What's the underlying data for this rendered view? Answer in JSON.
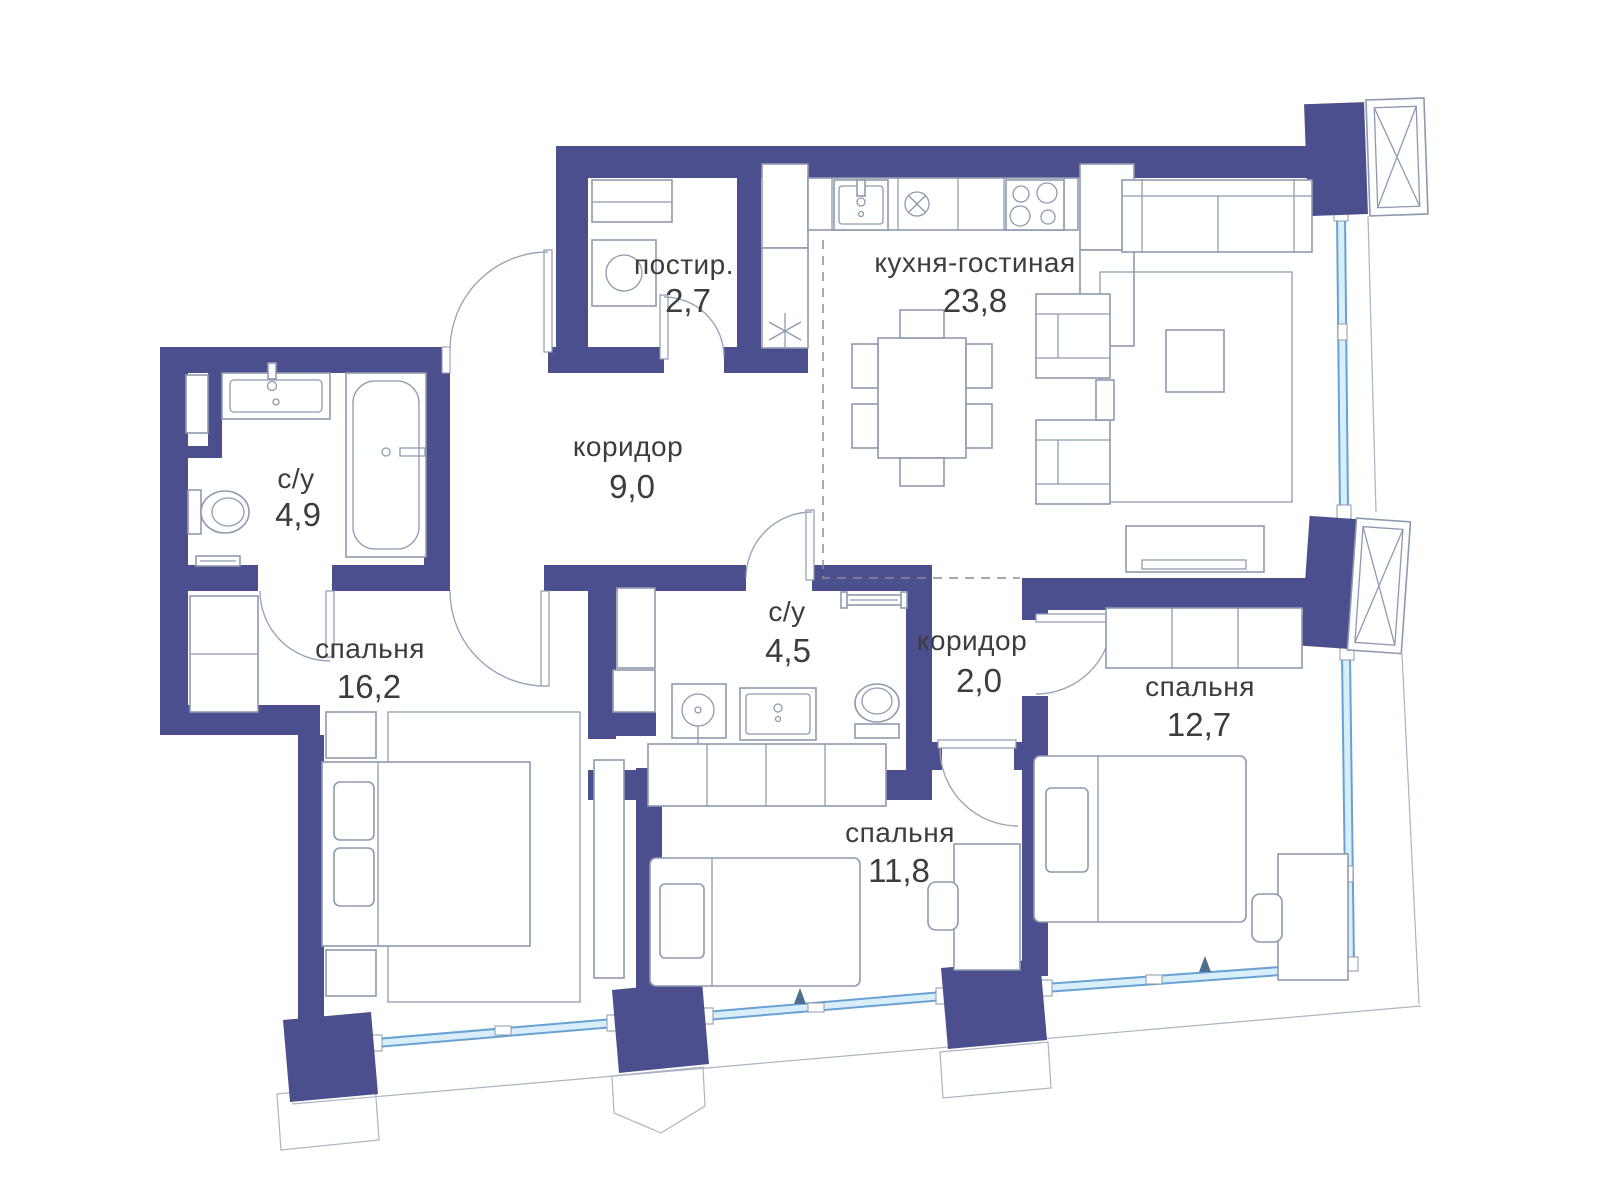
{
  "plan": {
    "title": "План квартиры",
    "rooms": [
      {
        "id": "laundry",
        "name": "постир.",
        "area": "2,7"
      },
      {
        "id": "kitchen-living",
        "name": "кухня-гостиная",
        "area": "23,8"
      },
      {
        "id": "hallway-main",
        "name": "коридор",
        "area": "9,0"
      },
      {
        "id": "bathroom-1",
        "name": "с/у",
        "area": "4,9"
      },
      {
        "id": "bedroom-1",
        "name": "спальня",
        "area": "16,2"
      },
      {
        "id": "bathroom-2",
        "name": "с/у",
        "area": "4,5"
      },
      {
        "id": "hallway-2",
        "name": "коридор",
        "area": "2,0"
      },
      {
        "id": "bedroom-2",
        "name": "спальня",
        "area": "12,7"
      },
      {
        "id": "bedroom-3",
        "name": "спальня",
        "area": "11,8"
      }
    ],
    "colors": {
      "wall": "#4c4f8d",
      "furniture_stroke": "#8d9aae",
      "glazing_fill": "#d9eefb",
      "glazing_stroke": "#69a2d2",
      "text": "#3d3d3d",
      "dashed_zone": "#8d8d8d"
    }
  }
}
